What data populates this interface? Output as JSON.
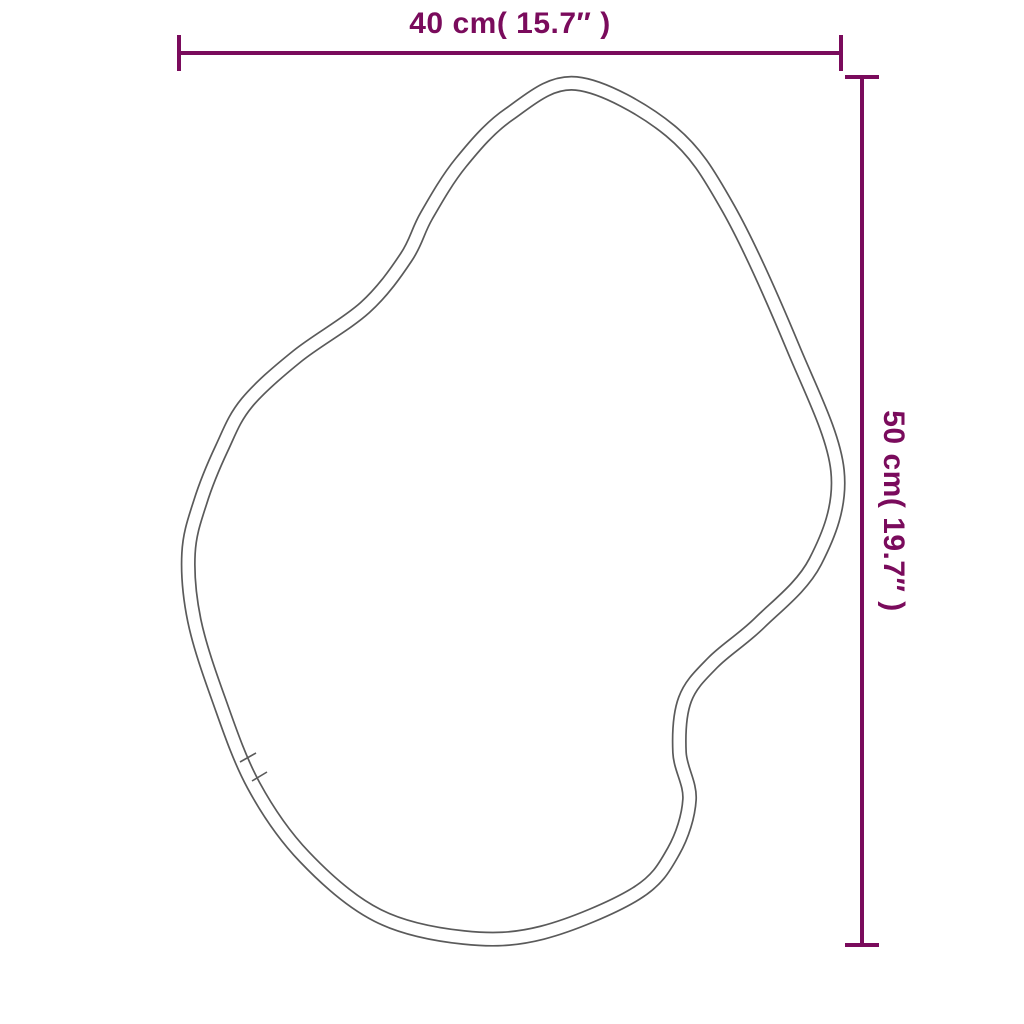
{
  "canvas": {
    "width": 1024,
    "height": 1024,
    "background": "#ffffff"
  },
  "diagram": {
    "kind": "product-dimension-diagram",
    "subject": "irregular organic-shaped wall mirror outline",
    "accent_color": "#7a0b5c",
    "outline_color": "#5a5a5a",
    "outline_band_width": 15,
    "outline_points": [
      [
        577,
        76
      ],
      [
        675,
        125
      ],
      [
        735,
        205
      ],
      [
        800,
        345
      ],
      [
        845,
        470
      ],
      [
        822,
        565
      ],
      [
        765,
        628
      ],
      [
        718,
        668
      ],
      [
        692,
        702
      ],
      [
        687,
        752
      ],
      [
        697,
        800
      ],
      [
        680,
        855
      ],
      [
        640,
        900
      ],
      [
        544,
        940
      ],
      [
        463,
        945
      ],
      [
        374,
        922
      ],
      [
        299,
        862
      ],
      [
        247,
        789
      ],
      [
        212,
        703
      ],
      [
        187,
        622
      ],
      [
        181,
        553
      ],
      [
        193,
        500
      ],
      [
        215,
        445
      ],
      [
        241,
        398
      ],
      [
        293,
        350
      ],
      [
        360,
        302
      ],
      [
        400,
        253
      ],
      [
        420,
        212
      ],
      [
        455,
        158
      ],
      [
        505,
        108
      ]
    ],
    "seam_marks": [
      {
        "x1": 240,
        "y1": 762,
        "x2": 256,
        "y2": 753
      },
      {
        "x1": 252,
        "y1": 781,
        "x2": 267,
        "y2": 772
      }
    ]
  },
  "dimensions": {
    "width": {
      "label": "40 cm( 15.7″ )",
      "line": {
        "x1": 179,
        "x2": 841,
        "y": 53
      },
      "tick_half": 18,
      "thickness": 4
    },
    "height": {
      "label": "50 cm( 19.7″ )",
      "line": {
        "y1": 77,
        "y2": 947,
        "x": 862
      },
      "tick_half": 17,
      "thickness": 4
    }
  }
}
